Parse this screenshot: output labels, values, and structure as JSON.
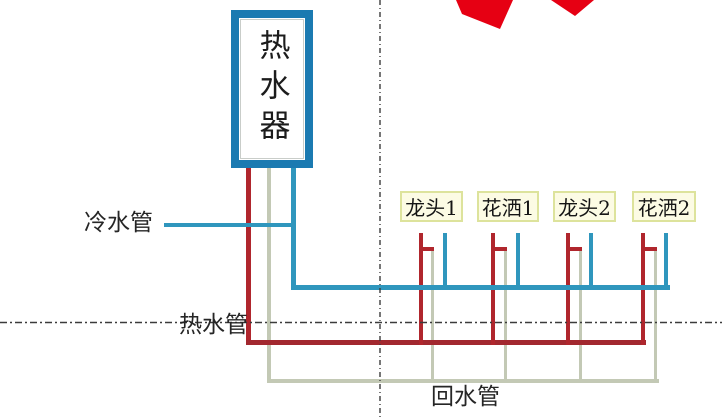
{
  "title": "hot-water-recirculation-plumbing-diagram",
  "heater": {
    "label": "热水器"
  },
  "pipes": {
    "cold_label": "冷水管",
    "hot_label": "热水管",
    "return_label": "回水管"
  },
  "fixtures": [
    {
      "label": "龙头1"
    },
    {
      "label": "花洒1"
    },
    {
      "label": "龙头2"
    },
    {
      "label": "花洒2"
    }
  ],
  "colors": {
    "pipe_cold": "#2f96bd",
    "pipe_hot": "#a2282f",
    "pipe_hot_bright": "#b0262d",
    "pipe_return": "#c3c9b5",
    "heater_border": "#1b7ab1",
    "label_box_bg": "#fcfbe4",
    "label_box_border": "#dde39c",
    "logo_red": "#e60013",
    "text": "#262626",
    "dash_line": "#3c3c3c"
  }
}
